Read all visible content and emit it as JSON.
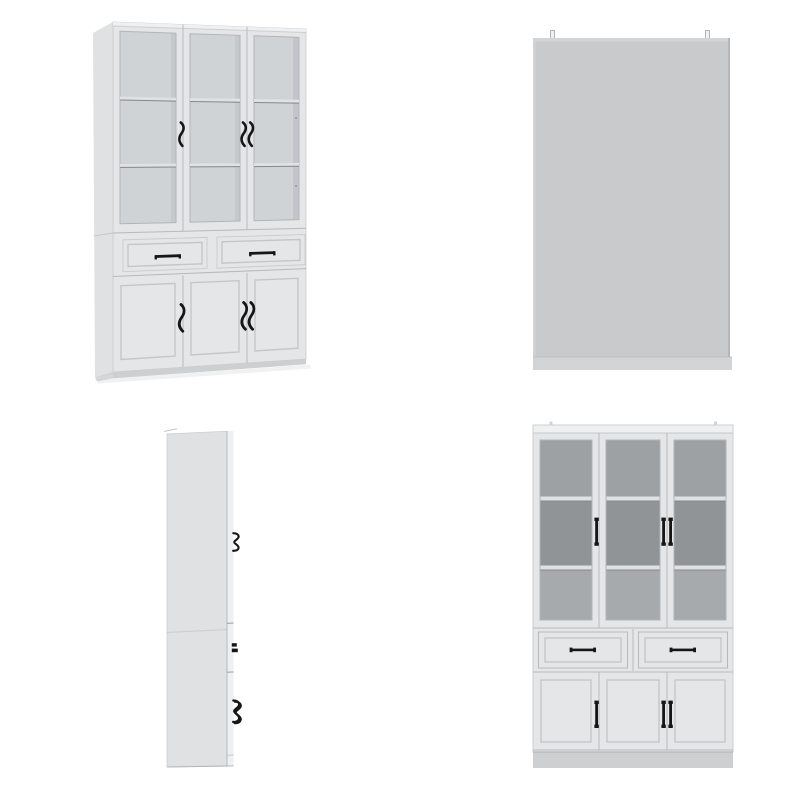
{
  "product": {
    "views_count": 4,
    "glass_doors": 3,
    "drawers": 2,
    "lower_doors": 3,
    "shelf_rows_per_glass_door": 3
  },
  "views": [
    {
      "id": "front-angled",
      "type": "3d-angled-render"
    },
    {
      "id": "back",
      "type": "flat-back-render"
    },
    {
      "id": "side",
      "type": "side-profile-render"
    },
    {
      "id": "front",
      "type": "flat-front-render"
    }
  ],
  "colors": {
    "bg": "#ffffff",
    "face": "#e4e6e8",
    "face-light": "#eef0f1",
    "side": "#dfe1e3",
    "plinth": "#cdcfd1",
    "shadow": "#ededee",
    "seam": "#b7b9bb",
    "seam-dark": "#94979a",
    "edge": "#c8cacc",
    "recess-line": "#c4c6c8",
    "glass-angled": "#cfd3d6",
    "glass-shade": "#b6babd",
    "glass-front-top": "#9da1a4",
    "glass-front-mid": "#909497",
    "glass-front-bottom": "#a6aaad",
    "glass-edge": "#b2b5b7",
    "shelf": "#dfe1e3",
    "shelf-line": "#85888b",
    "handle": "#161616",
    "back-panel": "#c8cacc",
    "back-band": "#d2d4d6",
    "back-edge": "#b4b6b8"
  }
}
